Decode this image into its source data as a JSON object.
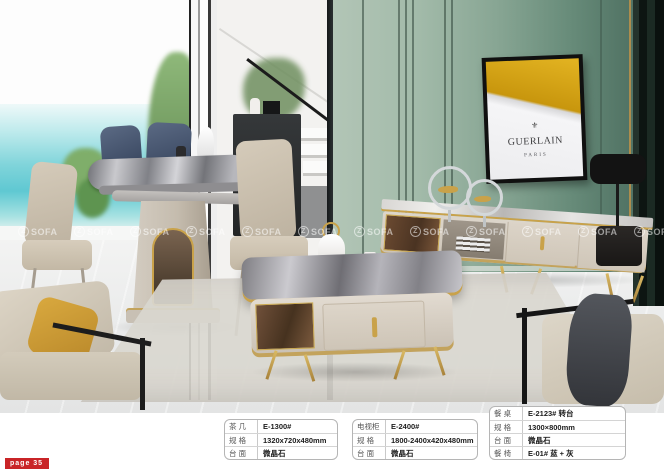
{
  "colors": {
    "accent_gold": "#c9a24a",
    "wall_green": "#7d9c8c",
    "poster_gold": "#d4a017",
    "sea_turquoise": "#6fd0d8",
    "badge_red": "#c92427"
  },
  "page_badge": {
    "text": "page 35"
  },
  "watermark": {
    "logo_letter": "Z",
    "brand": "SOFA",
    "count": 12
  },
  "poster": {
    "brand": "GUERLAIN",
    "city": "PARIS",
    "emblem_glyph": "⚜"
  },
  "spec_boxes": [
    {
      "id": "coffee-table",
      "rows": [
        {
          "label": "茶 几",
          "value": "E-1300#"
        },
        {
          "label": "规 格",
          "value": "1320x720x480mm"
        },
        {
          "label": "台 面",
          "value": "微晶石"
        }
      ]
    },
    {
      "id": "tv-cabinet",
      "rows": [
        {
          "label": "电视柜",
          "value": "E-2400#"
        },
        {
          "label": "规 格",
          "value": "1800-2400x420x480mm"
        },
        {
          "label": "台 面",
          "value": "微晶石"
        }
      ]
    },
    {
      "id": "dining-table",
      "rows": [
        {
          "label": "餐 桌",
          "value": "E-2123# 转台"
        },
        {
          "label": "规 格",
          "value": "1300×800mm"
        },
        {
          "label": "台 面",
          "value": "微晶石"
        },
        {
          "label": "餐 椅",
          "value": "E-01# 蓝 + 灰"
        }
      ]
    }
  ]
}
